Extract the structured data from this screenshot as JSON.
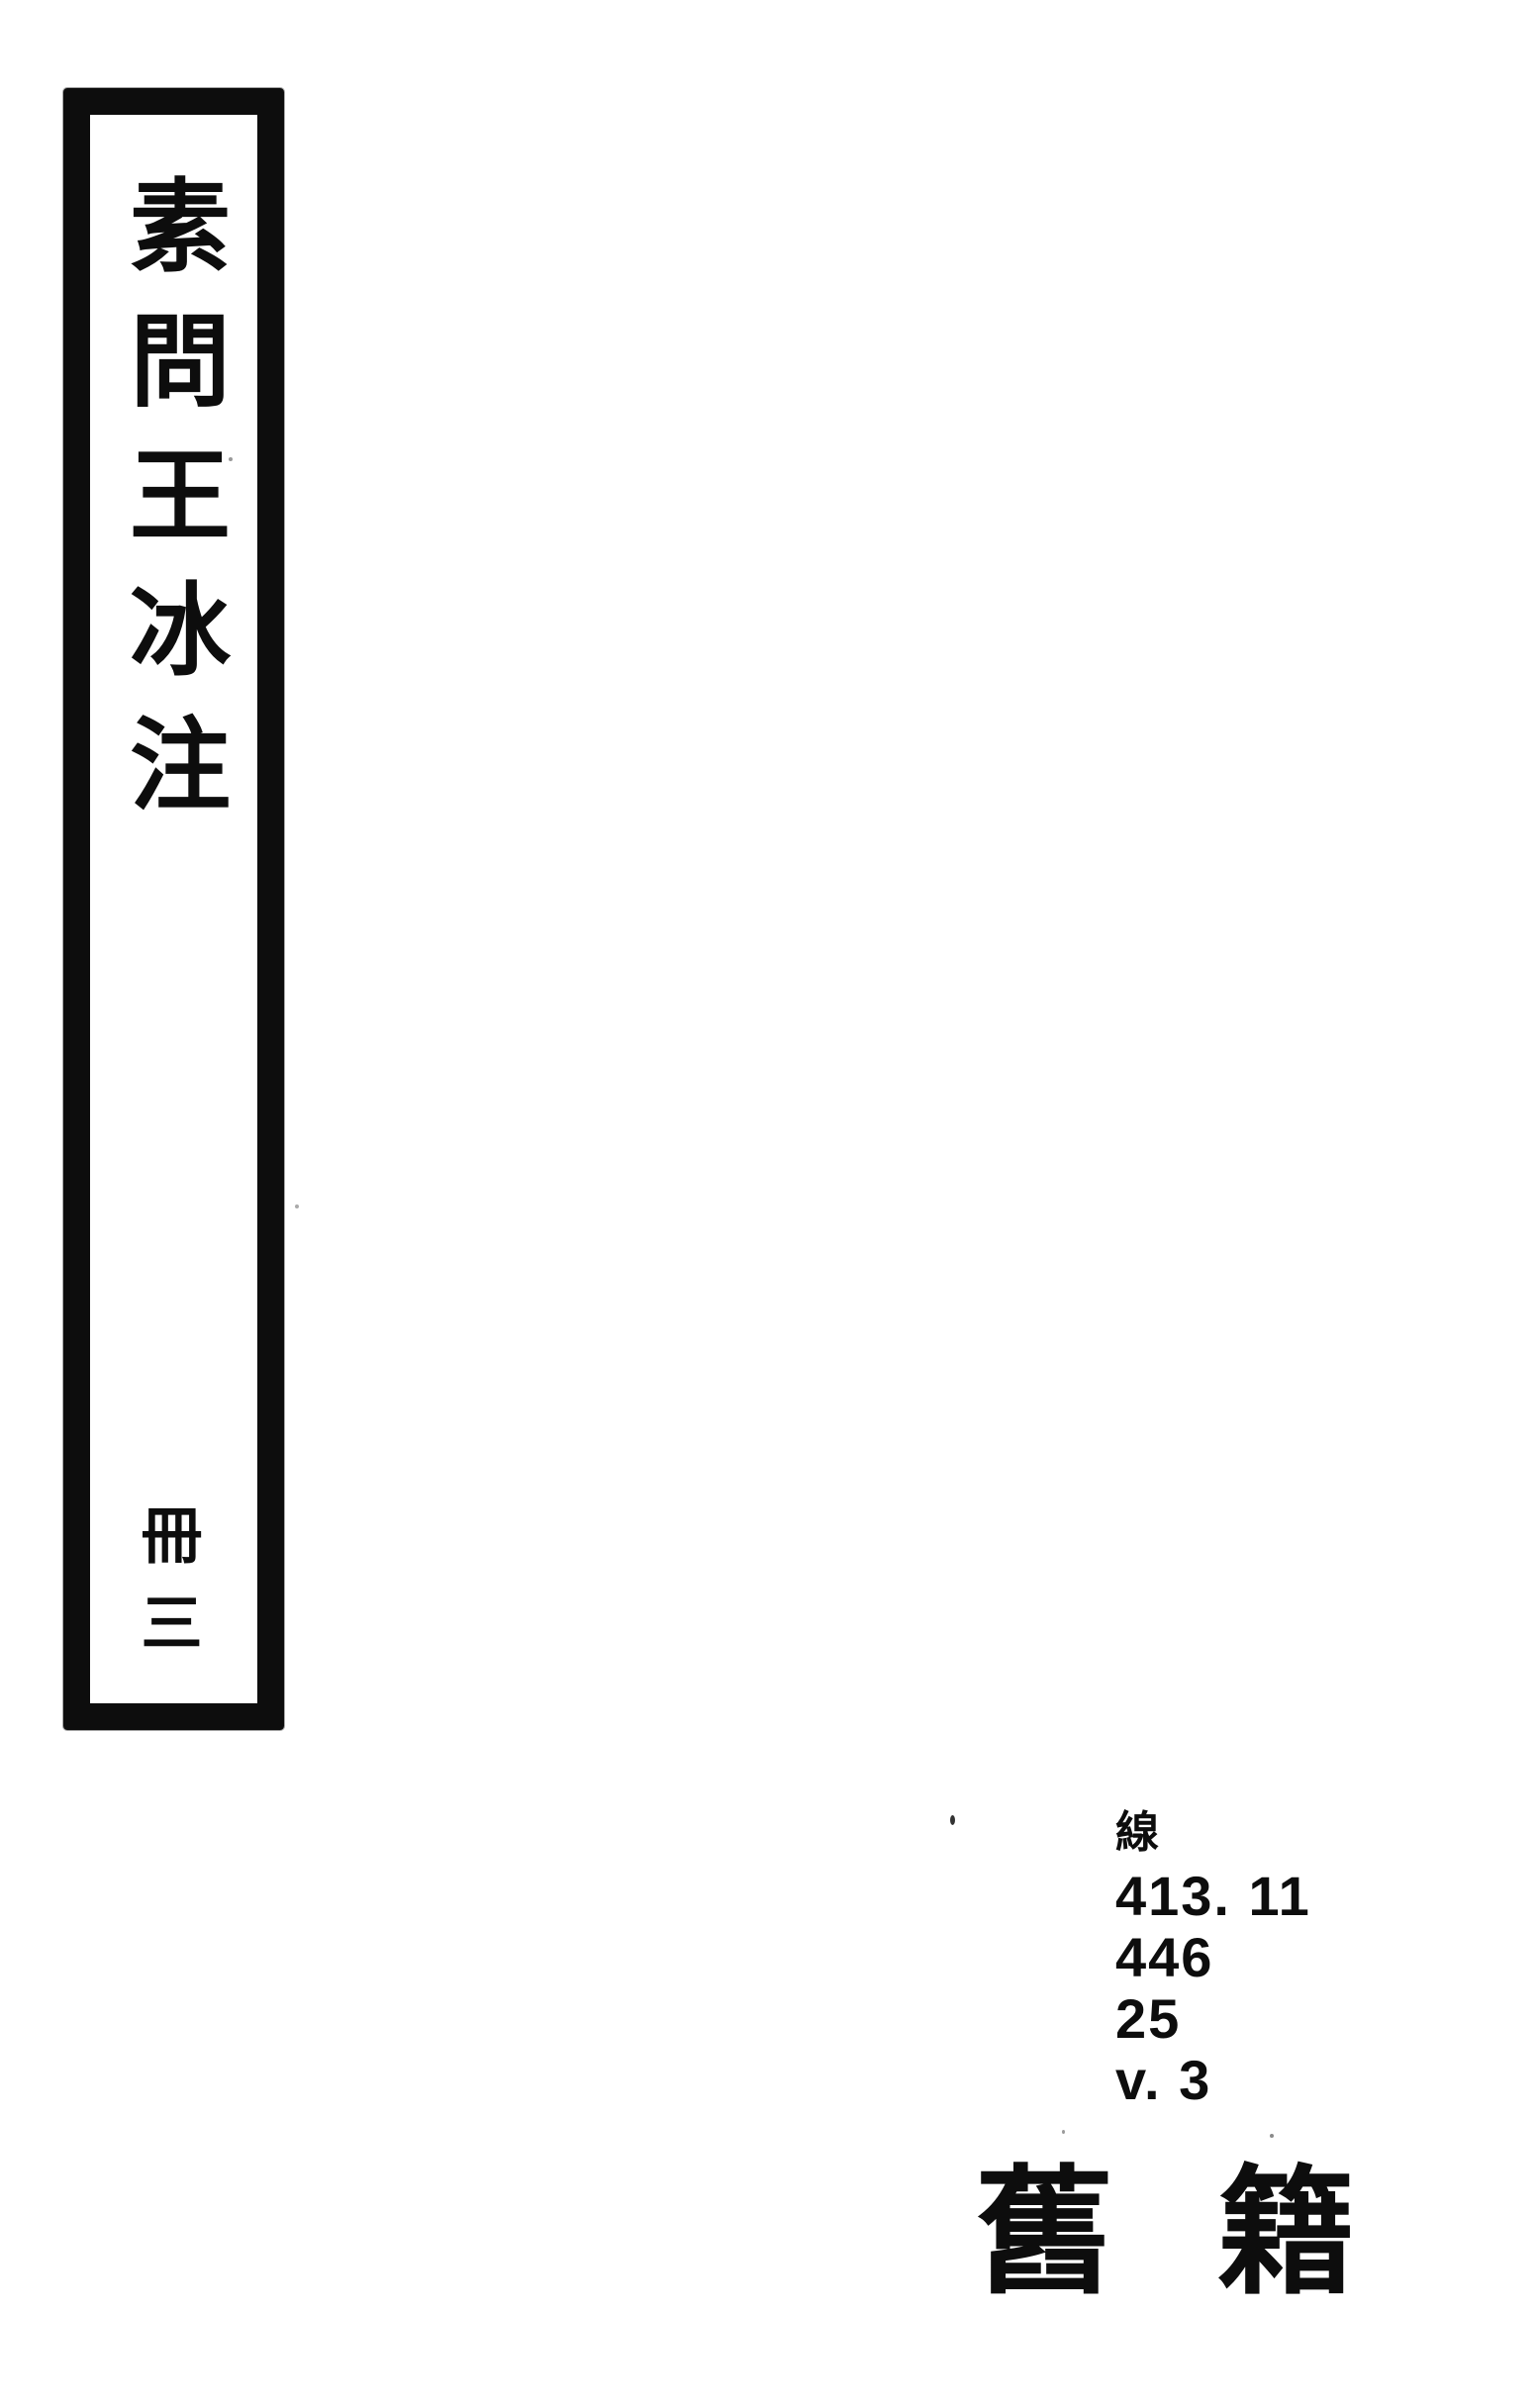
{
  "colors": {
    "ink": "#0d0d0d",
    "paper": "#ffffff"
  },
  "spine_label": {
    "title": "素問王冰注",
    "volume": "冊三"
  },
  "call_number": {
    "class_char": "線",
    "lines": [
      "413. 11",
      "446",
      "25",
      "v. 3"
    ]
  },
  "stamp": {
    "text": "舊籍"
  }
}
